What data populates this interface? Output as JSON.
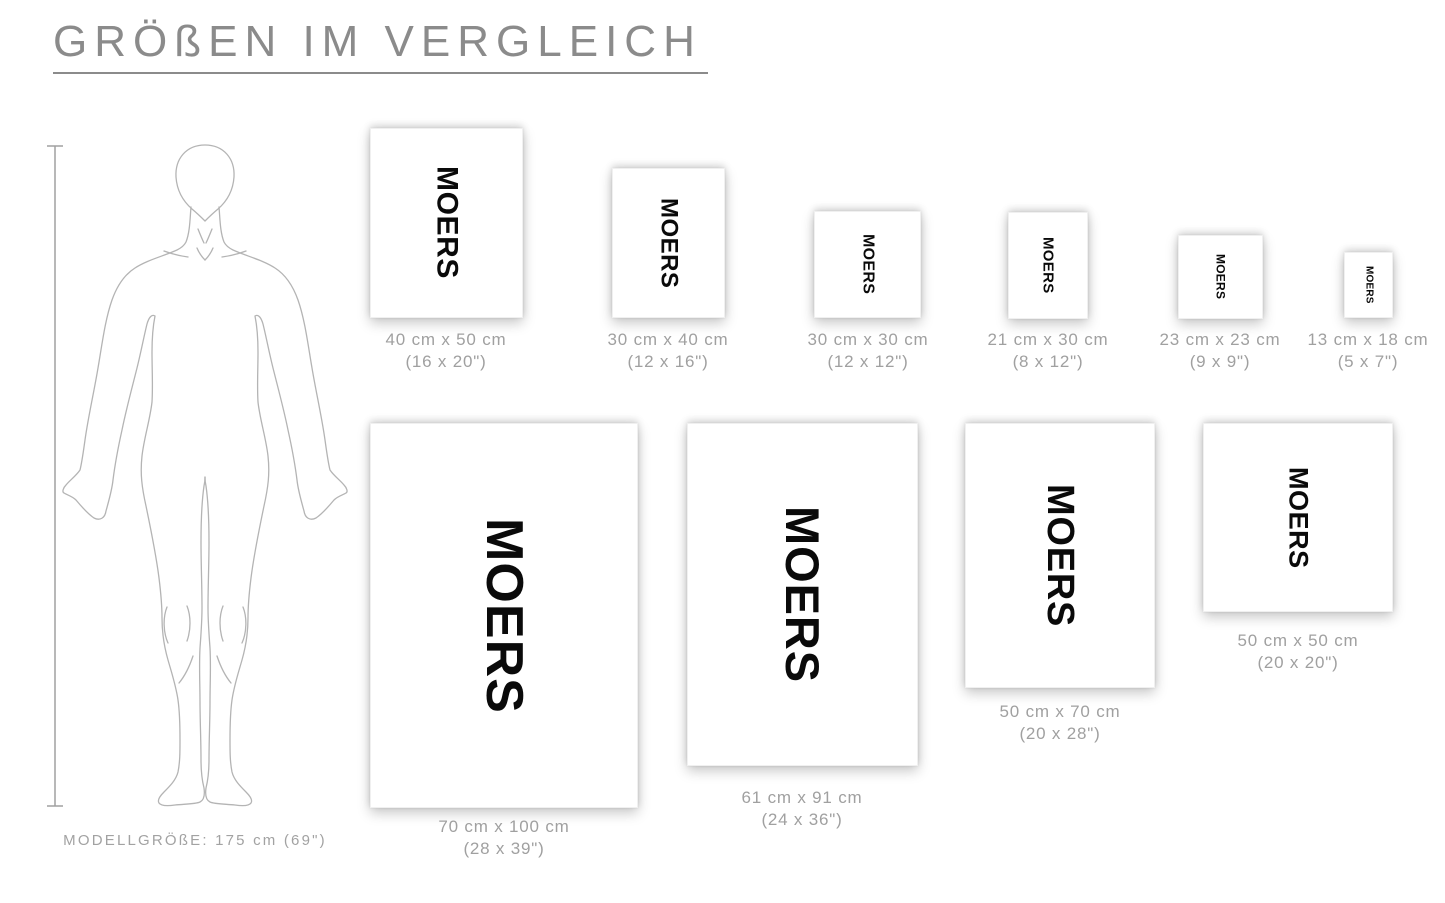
{
  "title": "GRÖßEN IM VERGLEICH",
  "poster_word": "MOERS",
  "model_figure": {
    "height_label": "MODELLGRÖßE: 175 cm (69\")"
  },
  "posters": [
    {
      "id": "40x50",
      "size_cm": "40 cm x 50 cm",
      "size_in": "(16 x 20\")"
    },
    {
      "id": "30x40",
      "size_cm": "30 cm x 40 cm",
      "size_in": "(12 x 16\")"
    },
    {
      "id": "30x30",
      "size_cm": "30 cm x 30 cm",
      "size_in": "(12 x 12\")"
    },
    {
      "id": "21x30",
      "size_cm": "21 cm x 30 cm",
      "size_in": "(8 x 12\")"
    },
    {
      "id": "23x23",
      "size_cm": "23 cm x 23 cm",
      "size_in": "(9 x 9\")"
    },
    {
      "id": "13x18",
      "size_cm": "13 cm x 18 cm",
      "size_in": "(5 x 7\")"
    },
    {
      "id": "70x100",
      "size_cm": "70 cm x 100 cm",
      "size_in": "(28 x 39\")"
    },
    {
      "id": "61x91",
      "size_cm": "61 cm x 91 cm",
      "size_in": "(24 x 36\")"
    },
    {
      "id": "50x70",
      "size_cm": "50 cm x 70 cm",
      "size_in": "(20 x 28\")"
    },
    {
      "id": "50x50",
      "size_cm": "50 cm x 50 cm",
      "size_in": "(20 x 20\")"
    }
  ],
  "colors": {
    "accent_text": "#8b8b8b",
    "label_text": "#a0a0a0",
    "artwork_text": "#0a0a0a",
    "figure_outline": "#b4b4b4"
  }
}
